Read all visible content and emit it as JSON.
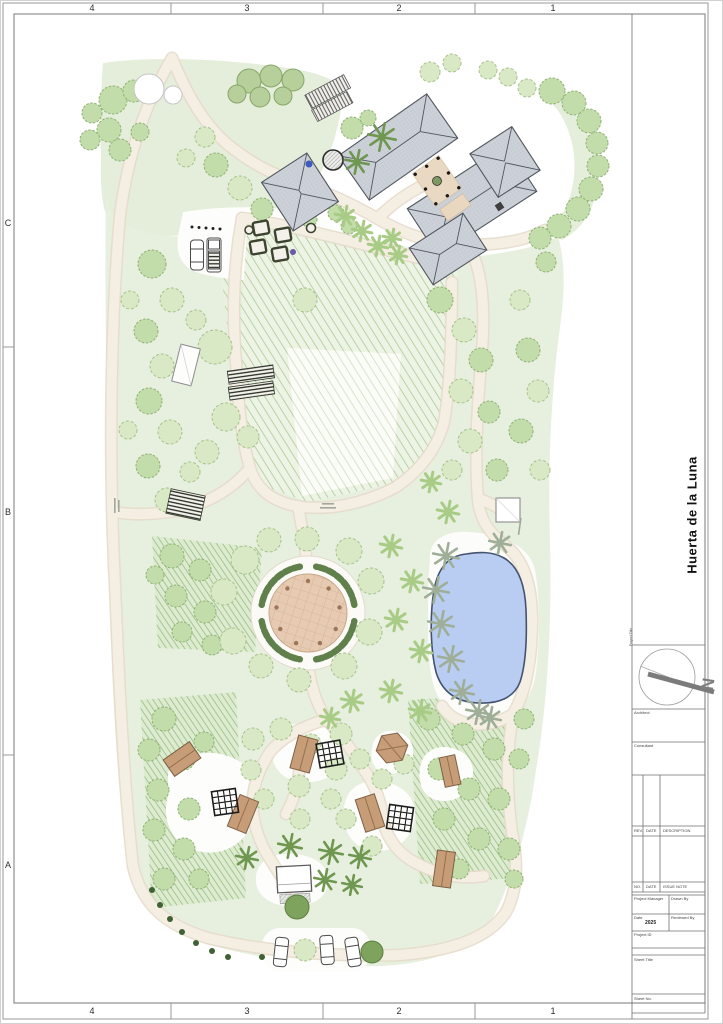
{
  "sheet": {
    "grid_columns": [
      "4",
      "3",
      "2",
      "1"
    ],
    "grid_rows": [
      "C",
      "B",
      "A"
    ],
    "title_block": {
      "project_title_label": "Project Title",
      "project_title": "Huerta de la Luna",
      "north_label": "N",
      "architect_label": "Architect",
      "consultant_label": "Consultant",
      "rev_header": {
        "rev": "REV.",
        "date": "DATE",
        "description": "DESCRIPTION"
      },
      "issue_header": {
        "no": "NO.",
        "date": "DATE",
        "note": "ISSUE NOTE"
      },
      "fields": {
        "project_manager_label": "Project Manager",
        "drawn_by_label": "Drawn By",
        "date_label": "Date",
        "date_value": "2025",
        "reviewed_by_label": "Reviewed By",
        "project_id_label": "Project ID",
        "sheet_title_label": "Sheet Title",
        "sheet_no_label": "Sheet No."
      }
    },
    "colors": {
      "site_green": "#e7efdf",
      "dark_green_hatch": "#9dbf85",
      "path_beige": "#f4eee3",
      "roof_gray": "#cdd2d9",
      "pool_blue": "#b9cdf2",
      "plaza_tan": "#e7cab2",
      "cabin_tan": "#c79d78",
      "hedge_green": "#5f7f4b",
      "tree_green": "#c2dcaa",
      "frame_gray": "#8f8f8f"
    }
  }
}
